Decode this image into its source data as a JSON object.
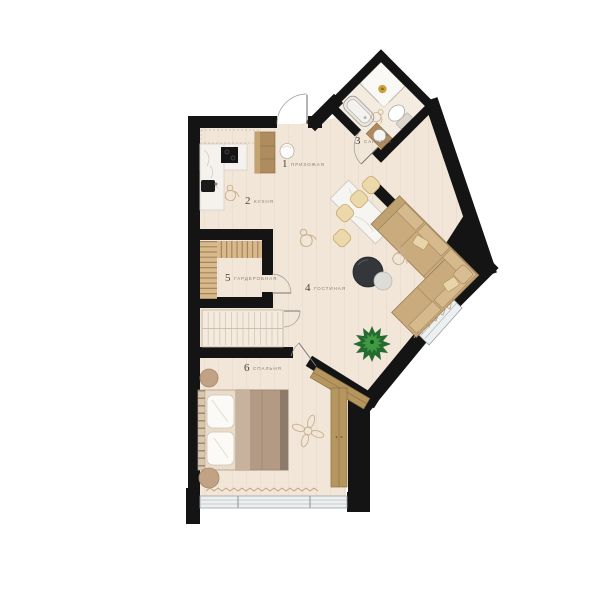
{
  "plan": {
    "title": "apartment-floor-plan",
    "rooms": [
      {
        "number": "1",
        "label": "ПРИХОЖАЯ"
      },
      {
        "number": "2",
        "label": "КУХНЯ"
      },
      {
        "number": "3",
        "label": "САНУЗЕЛ"
      },
      {
        "number": "4",
        "label": "ГОСТИНАЯ"
      },
      {
        "number": "5",
        "label": "ГАРДЕРОБНАЯ"
      },
      {
        "number": "6",
        "label": "СПАЛЬНЯ"
      }
    ],
    "colors": {
      "wall": "#141414",
      "floor": "#f1e6d8",
      "bath_floor": "#f4ece1",
      "wood": "#b5965f",
      "shelf_wood": "#d7b98c",
      "sofa": "#c9ab7e",
      "accent_gold": "#caa43a",
      "plant_dark": "#256b2f",
      "plant_light": "#3f9a42",
      "window_glass": "#edf0f0",
      "label_text": "#8a8178",
      "sketch": "#c8b28c"
    }
  }
}
